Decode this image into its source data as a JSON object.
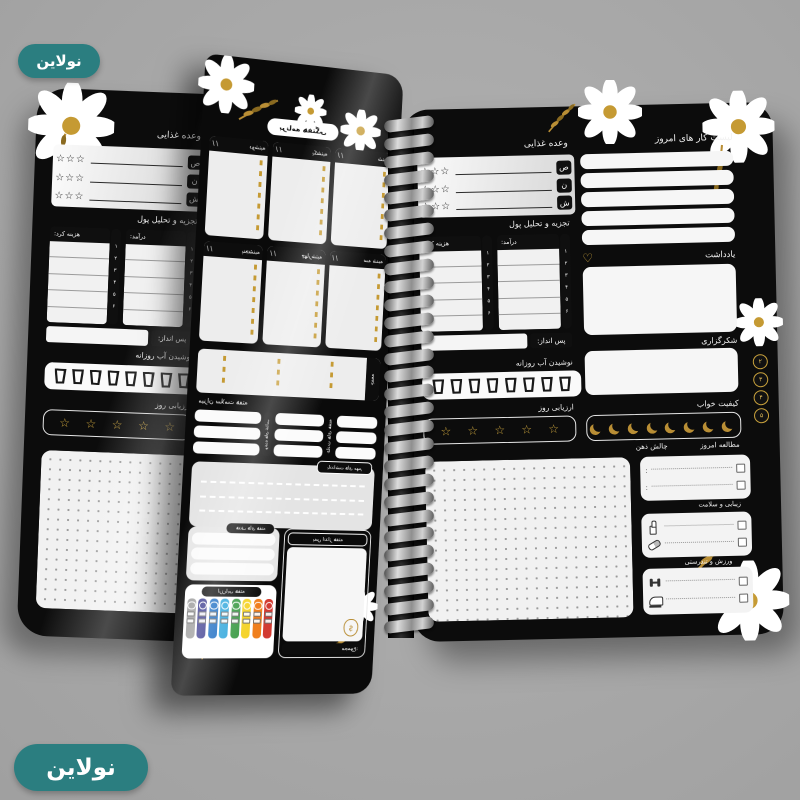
{
  "brand": {
    "name": "نولاین",
    "badge_color": "#2b7e80"
  },
  "colors": {
    "background": "#a8a8a8",
    "page_black": "#0c0c0c",
    "panel_light": "#ededed",
    "gold": "#c59a33",
    "teal": "#2b7e80",
    "white": "#ffffff"
  },
  "glyphs": {
    "star": "☆",
    "stars3": "☆☆☆",
    "heart": "♡",
    "slashes": "/ /",
    "colon": ":",
    "dollar": "$",
    "digits_v": "۱ ۲ ۳ ۴ ۵ ۶"
  },
  "left_page": {
    "meal": {
      "title": "وعده غذایی",
      "labels": [
        "ص",
        "ن",
        "ش"
      ]
    },
    "money": {
      "title": "تجزیه و تحلیل پول",
      "income": "درآمد:",
      "expense": "هزینه کرد:"
    },
    "savings": "پس انداز:",
    "water": "نوشیدن آب روزانه",
    "rating": "ارزیابی روز",
    "water_count": 8,
    "rating_stars": 5
  },
  "right_page": {
    "todo": "لیست کار های امروز",
    "todo_lines": 5,
    "meal": {
      "title": "وعده غذایی",
      "labels": [
        "ص",
        "ن",
        "ش"
      ]
    },
    "money": {
      "title": "تجزیه و تحلیل پول",
      "income": "درآمد:",
      "expense": "هزینه کرد:"
    },
    "savings": "پس انداز:",
    "water": "نوشیدن آب روزانه",
    "rating": "ارزیابی روز",
    "note": "یادداشت",
    "gratitude": "شکرگزاری",
    "sleep": "کیفیت خواب",
    "study": "مطالعه امروز",
    "mind": "چالش ذهن",
    "beauty": "زیبایی و سلامت",
    "fitness": "ورزش و تندرستی",
    "tabs": [
      "۲",
      "۳",
      "۴",
      "۵"
    ],
    "water_count": 8,
    "sleep_moons": 8,
    "rating_stars": 5
  },
  "middle_page": {
    "title": "برنامه هفتگی",
    "days": [
      "شنبه",
      "یکشنبه",
      "دوشنبه",
      "سه شنبه",
      "چهارشنبه",
      "پنجشنبه"
    ],
    "friday": "جمعه",
    "health_title": "میزان سلامت هفته",
    "meal_strip": "وعده های غذایی",
    "habit_strip": "عادت های هفته",
    "notes_title": "یادداشت های مهم",
    "goals_title": "هدف های هفته",
    "savings_title": "پس انداز هفته",
    "total_label": "مجموع:",
    "rating_title": "ارزیابی هفته",
    "rating_colors": [
      "#d23b32",
      "#f07f1e",
      "#f5d327",
      "#3d9c47",
      "#35a9dd",
      "#1f6fc4",
      "#3b3b8f",
      "#9e9e9e"
    ],
    "mirrored": true
  }
}
